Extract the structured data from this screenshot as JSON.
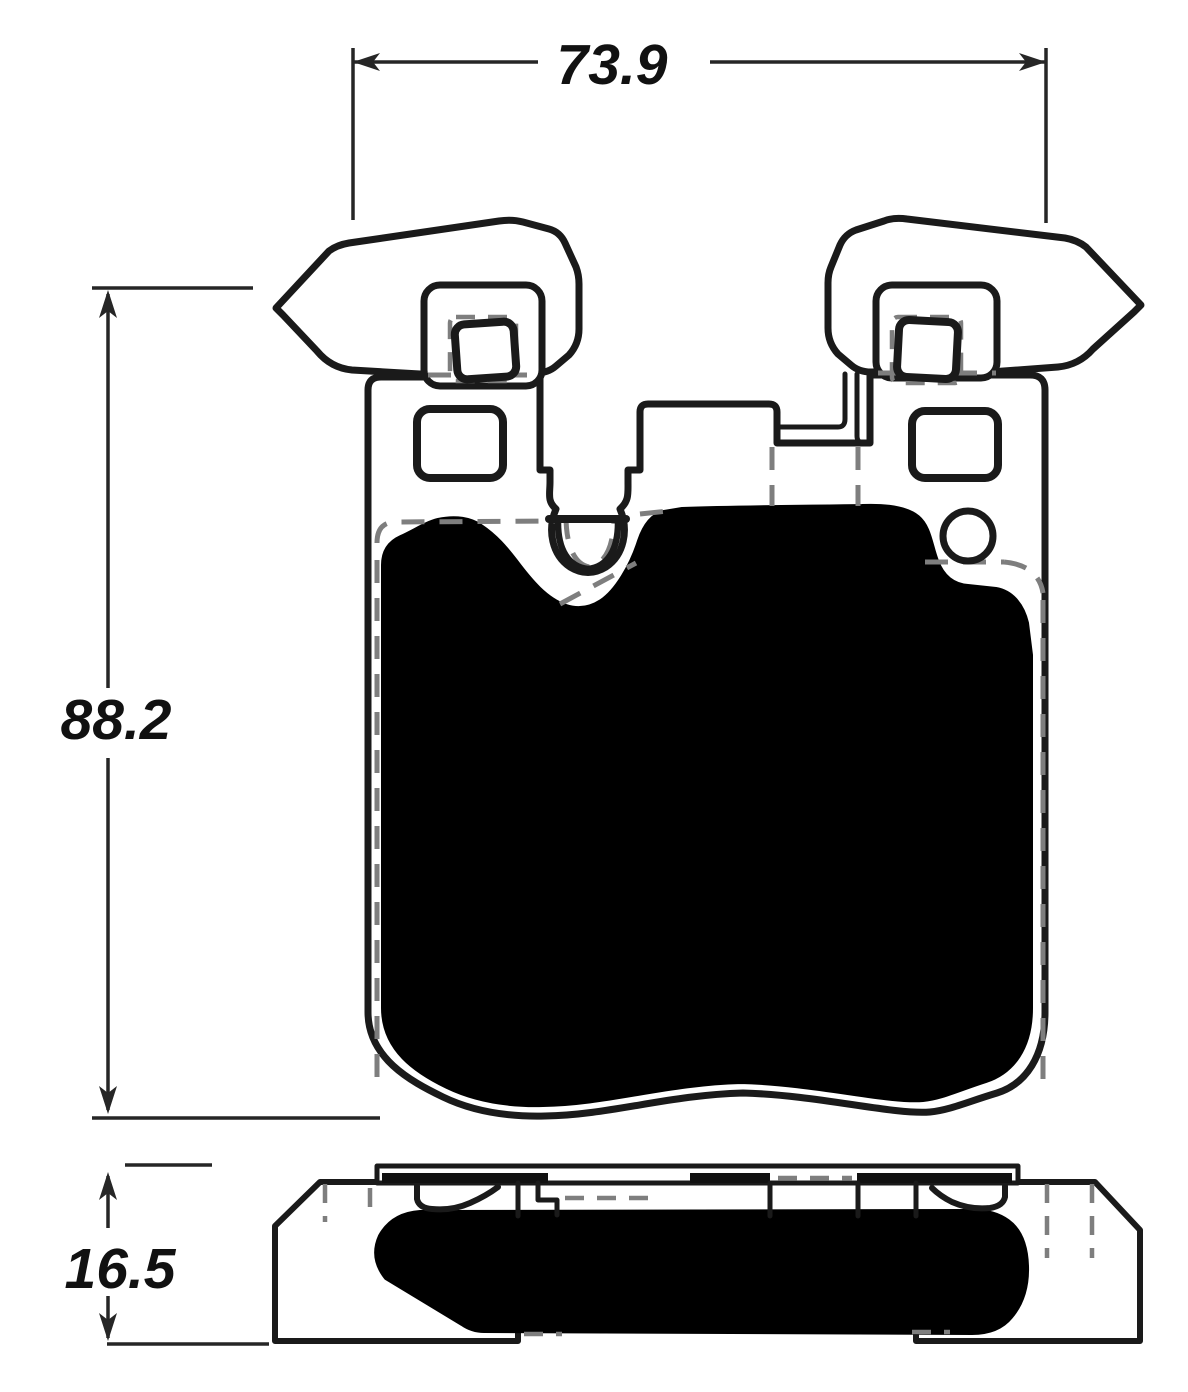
{
  "diagram": {
    "dimensions": {
      "width_label": "73.9",
      "height_label": "88.2",
      "thickness_label": "16.5"
    },
    "colors": {
      "line": "#1a1a1a",
      "hidden_line": "#7e7e7e",
      "friction_fill": "#000000",
      "background": "#ffffff"
    }
  }
}
